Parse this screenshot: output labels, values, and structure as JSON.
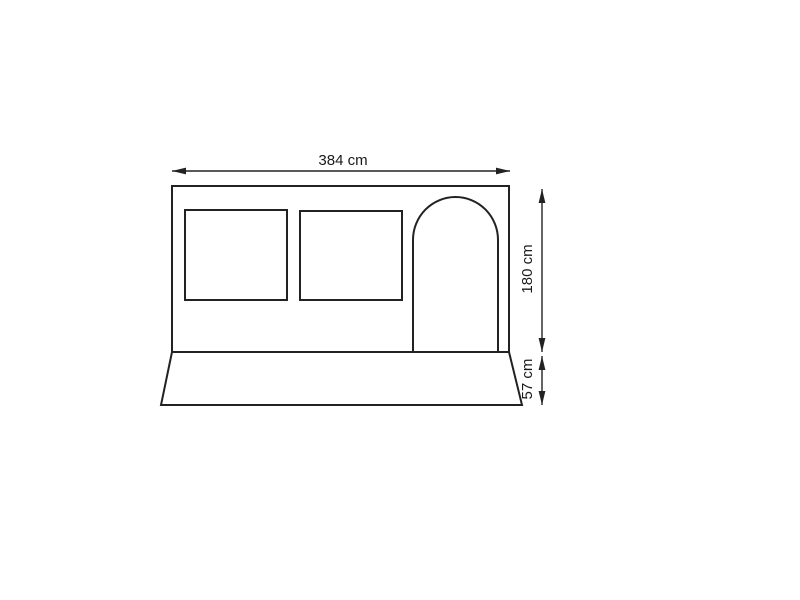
{
  "colors": {
    "line": "#222222",
    "text": "#1a1a1a",
    "background": "#ffffff"
  },
  "labels": {
    "width": "384 cm",
    "height": "180 cm",
    "skirt": "57 cm"
  },
  "dimensions": {
    "width_cm": 384,
    "height_cm": 180,
    "skirt_height_cm": 57
  }
}
